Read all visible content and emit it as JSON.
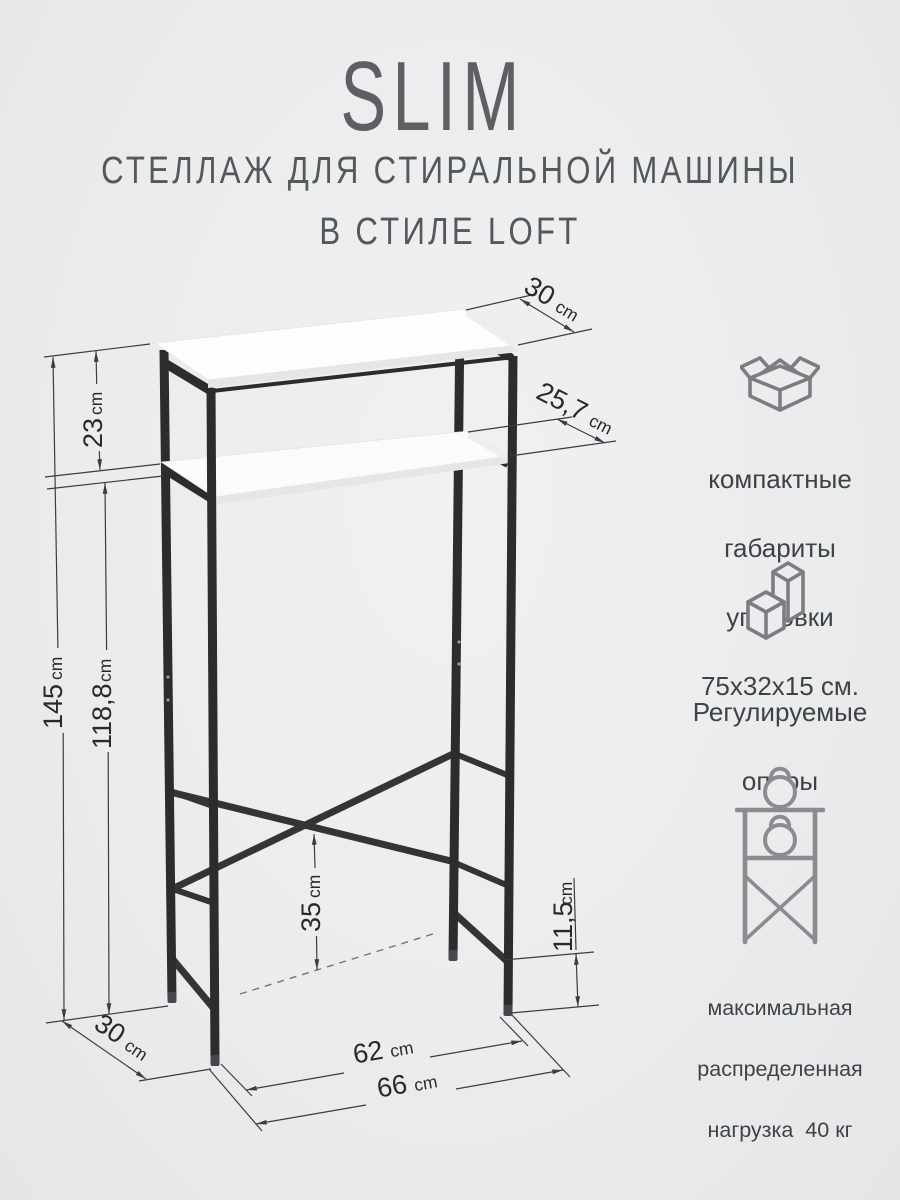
{
  "header": {
    "brand": "SLIM",
    "subtitle_line1": "СТЕЛЛАЖ ДЛЯ СТИРАЛЬНОЙ МАШИНЫ",
    "subtitle_line2": "В СТИЛЕ LOFT"
  },
  "dimensions": {
    "top_depth": {
      "value": "30",
      "unit": "cm"
    },
    "shelf_depth": {
      "value": "25,7",
      "unit": "cm"
    },
    "shelf_gap": {
      "value": "23",
      "unit": "cm"
    },
    "total_height": {
      "value": "145",
      "unit": "cm"
    },
    "clearance_height": {
      "value": "118,8",
      "unit": "cm"
    },
    "brace_height": {
      "value": "35",
      "unit": "cm"
    },
    "foot_clearance": {
      "value": "11,5",
      "unit": "cm"
    },
    "base_depth": {
      "value": "30",
      "unit": "cm"
    },
    "inner_width": {
      "value": "62",
      "unit": "cm"
    },
    "outer_width": {
      "value": "66",
      "unit": "cm"
    }
  },
  "features": [
    {
      "icon": "package-box-icon",
      "lines": [
        "компактные",
        "габариты",
        "упаковки",
        "75х32х15 см."
      ]
    },
    {
      "icon": "adjustable-feet-icon",
      "lines": [
        "Регулируемые",
        "опоры"
      ]
    },
    {
      "icon": "max-load-icon",
      "lines": [
        "максимальная",
        "распределенная",
        "нагрузка  40 кг"
      ]
    }
  ],
  "colors": {
    "background": "#ebeced",
    "steel": "#2a2c2e",
    "dimension_line": "#3b3d40",
    "title_text": "#5d5f62",
    "feature_text": "#3f4245",
    "icon_stroke": "#7b7d80",
    "shelf_white": "#fcfdfd"
  }
}
